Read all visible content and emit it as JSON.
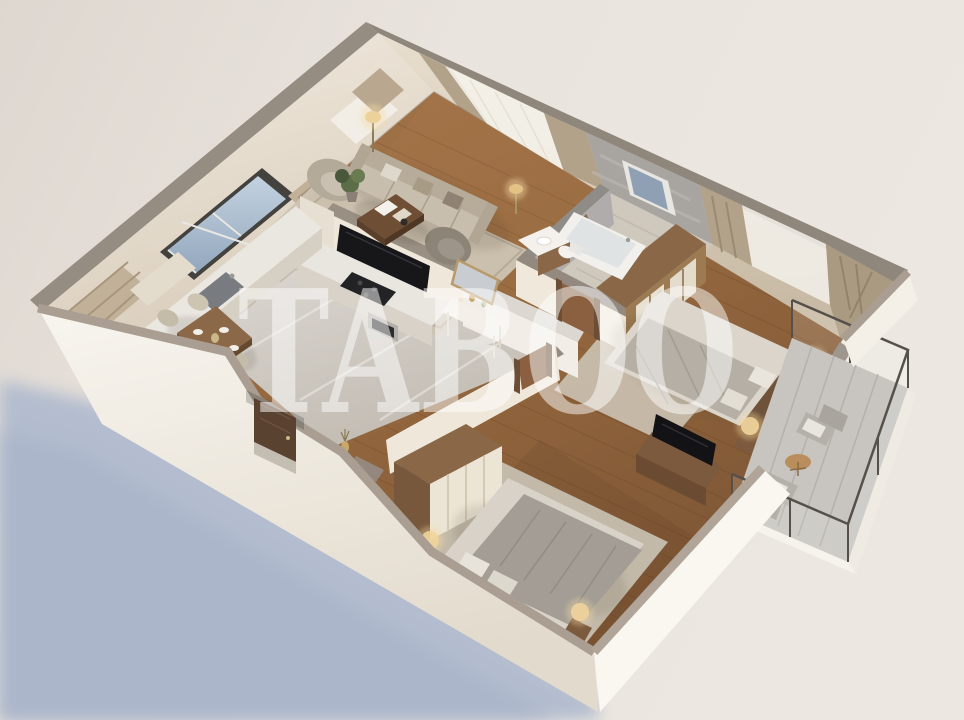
{
  "watermark": {
    "text": "TABOO",
    "color": "#ffffff",
    "opacity": "0.5"
  },
  "scene": {
    "type": "isometric-3d-apartment-floor-plan-render",
    "style": "photorealistic cutaway top-down render, no text labels",
    "background": {
      "paper": "#ece7e1",
      "paper_left": "#ddd6cf",
      "cast_shadow": "#b3bdcf"
    },
    "palette": {
      "exterior_wall": "#f6f2ea",
      "wall_top_cap": "#948a7f",
      "interior_wall": "#efe7da",
      "wood_floor": "#96693f",
      "kitchen_marble_floor": "#d9d4cd",
      "bathroom_marble": "#b0acab",
      "rug": "#cdc3b2",
      "sofa_upholstery": "#c8beae",
      "walnut_furniture": "#7c5a3d",
      "cream_wardrobe": "#ece4d4",
      "curtain_drape": "#b3a28a",
      "curtain_sheer": "#f5f2ec",
      "window_sky_glass": "#aabccf",
      "lamp_glow": "#f0d096",
      "tv_screen": "#131316",
      "balcony_railing": "#55504a"
    },
    "rooms": [
      {
        "name": "living-room",
        "furniture": [
          "sofa",
          "armchair-light",
          "armchair-dark",
          "coffee-table",
          "wall-tv",
          "floor-lamp",
          "gold-lamp",
          "plant",
          "rug",
          "sheer-and-drape-curtains"
        ]
      },
      {
        "name": "kitchen-dining",
        "furniture": [
          "wall-counter-with-sink",
          "island-counter-with-cooktop",
          "oven",
          "tall-cabinet",
          "dining-table",
          "dining-chairs",
          "window-bench",
          "framed-window"
        ]
      },
      {
        "name": "hallway",
        "furniture": [
          "console-table",
          "gold-mirror",
          "entrance-door",
          "decor-vase",
          "doormat"
        ]
      },
      {
        "name": "bathroom",
        "furniture": [
          "bathtub",
          "vanity-with-sink",
          "wall-mirror",
          "toilet",
          "window"
        ]
      },
      {
        "name": "bedroom-1",
        "furniture": [
          "double-bed",
          "headboard",
          "nightstand-left",
          "nightstand-right",
          "table-lamps",
          "walnut-closet",
          "rug",
          "curtains"
        ]
      },
      {
        "name": "bedroom-2",
        "furniture": [
          "double-bed",
          "headboard",
          "nightstand-left",
          "nightstand-right",
          "cream-wardrobe",
          "tv-console",
          "tv",
          "rug"
        ]
      },
      {
        "name": "balcony",
        "furniture": [
          "outdoor-armchair",
          "outdoor-armchair",
          "round-side-table",
          "glass-railing"
        ]
      }
    ]
  }
}
